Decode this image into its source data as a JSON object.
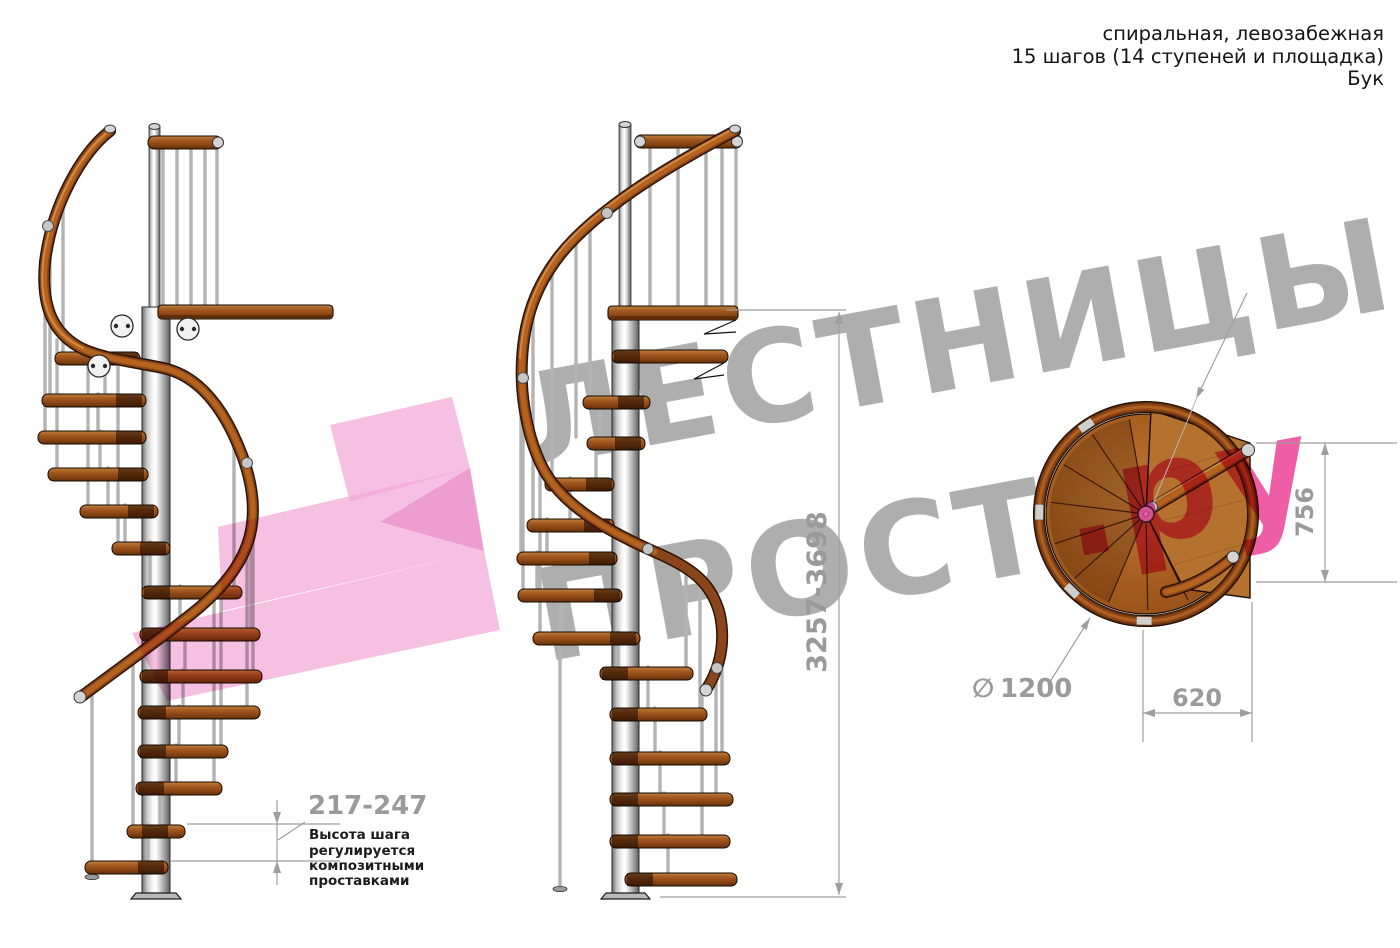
{
  "header": {
    "line1": "спиральная, левозабежная",
    "line2": "15 шагов (14 ступеней и площадка)",
    "line3": "Бук"
  },
  "watermark": {
    "word_top": "ЛЕСТНИЦЫ",
    "word_bottom": "ПРОСТО",
    "suffix": ".ру"
  },
  "dimensions": {
    "total_height": "3257-3698",
    "step_height": "217-247",
    "diameter_symbol": "∅",
    "diameter_value": "1200",
    "plan_width": "620",
    "plan_depth": "756"
  },
  "note": {
    "lines": [
      "Высота шага",
      "регулируется",
      "композитными",
      "проставками"
    ]
  },
  "colors": {
    "accent_pink": "#ee4f9e",
    "logo_pink": "#f2a7d7",
    "watermark_gray": "#9a9a9a",
    "dimension_gray": "#9e9e9e",
    "wood_brown": "#a2581e",
    "metal_gray": "#c8c8c8"
  }
}
